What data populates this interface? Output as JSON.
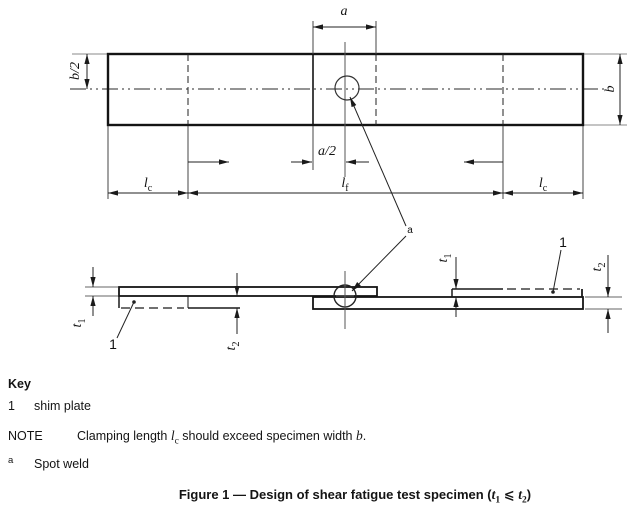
{
  "drawing": {
    "dim_labels": {
      "a": "a",
      "a_half": "a/2",
      "b": "b",
      "b_half": "b/2",
      "l": "l",
      "c_sub": "c",
      "f_sub": "f",
      "t": "t",
      "one_sub": "1",
      "two_sub": "2",
      "shim_ref": "1",
      "weld_ref": "a"
    }
  },
  "key": {
    "title": "Key",
    "item_1": {
      "ref": "1",
      "text": "shim plate"
    },
    "note": {
      "label": "NOTE",
      "pre": "Clamping length ",
      "sym_l": "l",
      "sym_l_sub": "c",
      "mid": " should exceed specimen width ",
      "sym_b": "b",
      "post": "."
    },
    "footnote": {
      "ref": "a",
      "text": "Spot weld"
    }
  },
  "caption": {
    "pre": "Figure 1 — Design of shear fatigue test specimen (",
    "t1": "t",
    "t1_sub": "1",
    "rel": " ⩽ ",
    "t2": "t",
    "t2_sub": "2",
    "post": ")"
  }
}
